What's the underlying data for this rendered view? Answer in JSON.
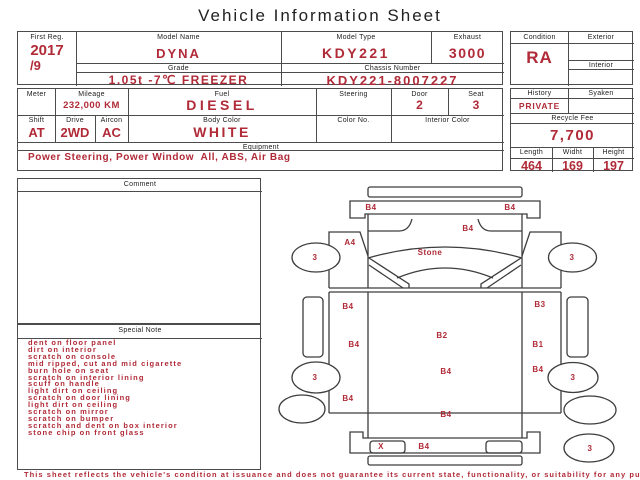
{
  "title": "Vehicle Information Sheet",
  "footer": "This sheet reflects the vehicle's condition at issuance and does not guarantee its current state, functionality, or suitability for any purpose",
  "colors": {
    "accent": "#b02a37",
    "ink": "#1c1c1c",
    "border": "#4c4c4c"
  },
  "info": {
    "first_reg": {
      "label": "First Reg.",
      "year": "2017",
      "month": "/9"
    },
    "model_name": {
      "label": "Model Name",
      "value": "DYNA"
    },
    "model_type": {
      "label": "Model Type",
      "value": "KDY221"
    },
    "exhaust": {
      "label": "Exhaust",
      "value": "3000"
    },
    "grade": {
      "label": "Grade",
      "value": "1.05t -7℃ FREEZER"
    },
    "chassis_number": {
      "label": "Chassis Number",
      "value": "KDY221-8007227"
    },
    "condition": {
      "label": "Condition",
      "value": "RA"
    },
    "exterior": {
      "label": "Exterior",
      "value": ""
    },
    "interior": {
      "label": "Interior",
      "value": ""
    },
    "meter": {
      "label": "Meter",
      "value": ""
    },
    "mileage": {
      "label": "Mileage",
      "value": "232,000 KM"
    },
    "fuel": {
      "label": "Fuel",
      "value": "DIESEL"
    },
    "steering": {
      "label": "Steering",
      "value": ""
    },
    "door": {
      "label": "Door",
      "value": "2"
    },
    "seat": {
      "label": "Seat",
      "value": "3"
    },
    "history": {
      "label": "History",
      "value": "PRIVATE"
    },
    "syaken": {
      "label": "Syaken",
      "value": ""
    },
    "shift": {
      "label": "Shift",
      "value": "AT"
    },
    "drive": {
      "label": "Drive",
      "value": "2WD"
    },
    "aircon": {
      "label": "Aircon",
      "value": "AC"
    },
    "body_color": {
      "label": "Body Color",
      "value": "WHITE"
    },
    "color_no": {
      "label": "Color No.",
      "value": ""
    },
    "interior_color": {
      "label": "Interior Color",
      "value": ""
    },
    "recycle_fee": {
      "label": "Recycle Fee",
      "value": "7,700"
    },
    "equipment": {
      "label": "Equipment",
      "value": "Power Steering, Power Window  All, ABS, Air Bag"
    },
    "length": {
      "label": "Length",
      "value": "464"
    },
    "widht": {
      "label": "Widht",
      "value": "169"
    },
    "height": {
      "label": "Height",
      "value": "197"
    }
  },
  "comment": {
    "label": "Comment",
    "value": ""
  },
  "special_note": {
    "label": "Special Note",
    "items": [
      "dent on floor panel",
      "dirt on interior",
      "scratch on console",
      "mid ripped, cut and mid cigarette",
      "burn hole on seat",
      "scratch on interior lining",
      "scuff on handle",
      "light dirt on ceiling",
      "scratch on door lining",
      "light dirt on ceiling",
      "scratch on mirror",
      "scratch on bumper",
      "scratch and dent on box interior",
      "stone chip on front glass"
    ]
  },
  "diagram": {
    "marks": [
      {
        "code": "B4",
        "location": "front-panel-left"
      },
      {
        "code": "B4",
        "location": "front-panel-right"
      },
      {
        "code": "B4",
        "location": "cab-front-center"
      },
      {
        "code": "A4",
        "location": "left-front-fender"
      },
      {
        "code": "Stone",
        "location": "windshield"
      },
      {
        "code": "3",
        "location": "left-mirror"
      },
      {
        "code": "3",
        "location": "right-mirror"
      },
      {
        "code": "B4",
        "location": "left-side-front"
      },
      {
        "code": "B3",
        "location": "right-side-front"
      },
      {
        "code": "B2",
        "location": "cargo-box-center"
      },
      {
        "code": "B4",
        "location": "left-side-middle"
      },
      {
        "code": "B1",
        "location": "right-side-middle"
      },
      {
        "code": "B4",
        "location": "cargo-box-lower"
      },
      {
        "code": "B4",
        "location": "right-side-lower"
      },
      {
        "code": "3",
        "location": "left-rear-wheel-front"
      },
      {
        "code": "3",
        "location": "right-rear-wheel-front"
      },
      {
        "code": "B4",
        "location": "left-side-rear"
      },
      {
        "code": "B4",
        "location": "box-rear-edge"
      },
      {
        "code": "X",
        "location": "rear-bumper-left"
      },
      {
        "code": "B4",
        "location": "rear-bumper-center"
      },
      {
        "code": "3",
        "location": "spare-tire"
      }
    ]
  }
}
